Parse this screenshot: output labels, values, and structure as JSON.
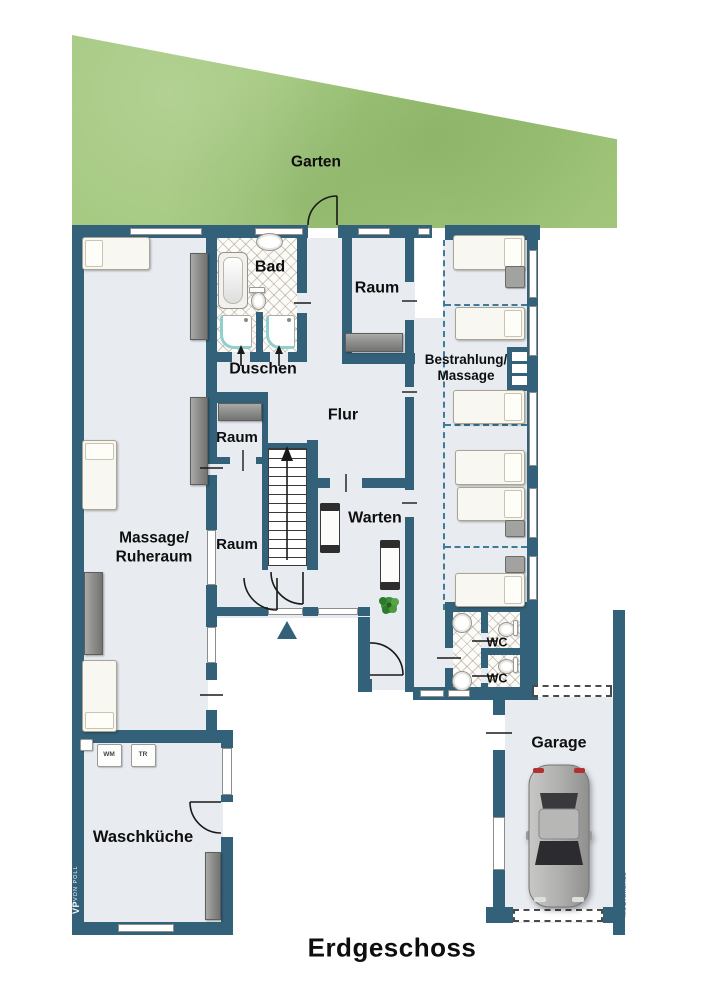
{
  "page_title": "Erdgeschoss",
  "labels": {
    "garden": "Garten",
    "bad": "Bad",
    "duschen": "Duschen",
    "raum_top": "Raum",
    "raum_upper": "Raum",
    "raum_lower": "Raum",
    "flur": "Flur",
    "warten": "Warten",
    "massage_line1": "Massage/",
    "massage_line2": "Ruheraum",
    "bestrahlung_line1": "Bestrahlung/",
    "bestrahlung_line2": "Massage",
    "wc_upper": "WC",
    "wc_lower": "WC",
    "garage": "Garage",
    "waschkueche": "Waschküche",
    "wm": "WM",
    "tr": "TR",
    "floor_title": "Erdgeschoss"
  },
  "watermarks": {
    "left_initials": "VP",
    "left_name": "VON POLL",
    "right": "McGrundriss"
  },
  "colors": {
    "wall": "#336179",
    "floor": "#e8ecf1",
    "garden": "#a3c87e",
    "dashed": "#3f7a99"
  }
}
